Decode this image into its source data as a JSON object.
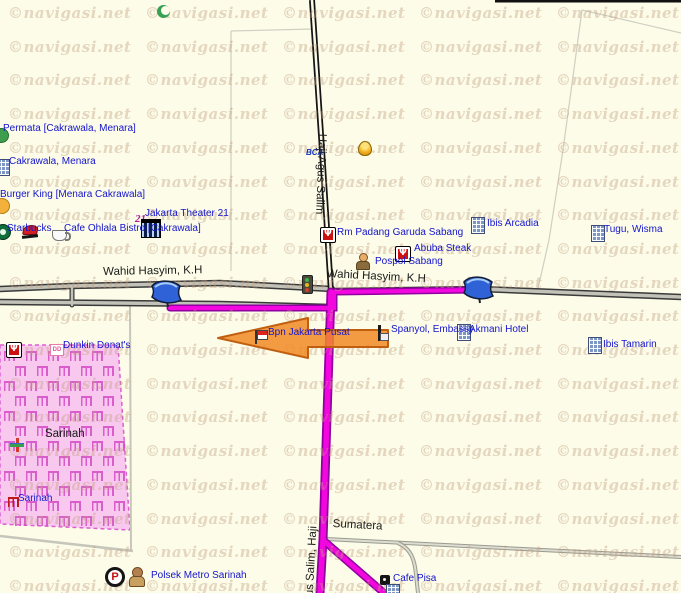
{
  "watermark": {
    "text": "©navigasi.net"
  },
  "map": {
    "colors": {
      "background": "#FCFCE8",
      "route": "#F207DE",
      "arrow": "#F18A26",
      "area_pink": "#F8C8EF",
      "poi_label": "#1414CC",
      "road_label": "#1B1B1B",
      "watermark": "rgba(196,158,128,0.40)"
    },
    "road_labels": [
      {
        "text": "Wahid Hasyim, K.H",
        "x": 103,
        "y": 266,
        "rot": -1
      },
      {
        "text": "Wahid Hasyim, K.H",
        "x": 327,
        "y": 268,
        "rot": 3
      },
      {
        "text": "Haji Agus Salim",
        "x": 328,
        "y": 134,
        "rot": 92
      },
      {
        "text": "Agus Salim, Haji",
        "x": 303,
        "y": 610,
        "rot": -87
      },
      {
        "text": "Sumatera",
        "x": 333,
        "y": 518,
        "rot": 3
      },
      {
        "text": "Sarinah",
        "x": 45,
        "y": 428,
        "rot": 0
      }
    ],
    "poi_labels": [
      {
        "text": "Permata [Cakrawala, Menara]",
        "x": 3,
        "y": 123
      },
      {
        "text": "Cakrawala, Menara",
        "x": 9,
        "y": 156
      },
      {
        "text": "Burger King [Menara Cakrawala]",
        "x": 0,
        "y": 189
      },
      {
        "text": "Jakarta Theater 21",
        "x": 145,
        "y": 208
      },
      {
        "text": "Starbucks",
        "x": 7,
        "y": 223
      },
      {
        "text": "Cafe Ohlala Bistro [Cakrawala]",
        "x": 64,
        "y": 223
      },
      {
        "text": "Rm Padang Garuda Sabang",
        "x": 337,
        "y": 227
      },
      {
        "text": "Abuba Steak",
        "x": 414,
        "y": 243
      },
      {
        "text": "Pospol Sabang",
        "x": 375,
        "y": 256
      },
      {
        "text": "Ibis Arcadia",
        "x": 487,
        "y": 218
      },
      {
        "text": "Tugu, Wisma",
        "x": 604,
        "y": 224
      },
      {
        "text": "Akmani Hotel",
        "x": 469,
        "y": 324
      },
      {
        "text": "Ibis Tamarin",
        "x": 603,
        "y": 339
      },
      {
        "text": "Spanyol, Embassy",
        "x": 391,
        "y": 324
      },
      {
        "text": "Bpn Jakarta Pusat",
        "x": 268,
        "y": 327
      },
      {
        "text": "Dunkin Donat's",
        "x": 63,
        "y": 340
      },
      {
        "text": "Sarinah",
        "x": 18,
        "y": 493
      },
      {
        "text": "Polsek Metro Sarinah",
        "x": 151,
        "y": 570
      },
      {
        "text": "Cafe Pisa",
        "x": 393,
        "y": 573
      }
    ],
    "icons": [
      {
        "name": "mosque-icon",
        "x": 157,
        "y": 5
      },
      {
        "name": "bca-icon",
        "x": 306,
        "y": 142
      },
      {
        "name": "bell-icon",
        "x": 358,
        "y": 141
      },
      {
        "name": "tree-icon",
        "x": -6,
        "y": 128
      },
      {
        "name": "building-icon",
        "x": -4,
        "y": 159
      },
      {
        "name": "bk-icon",
        "x": -6,
        "y": 198
      },
      {
        "name": "two1-icon",
        "x": 135,
        "y": 209
      },
      {
        "name": "theater-icon",
        "x": 141,
        "y": 219
      },
      {
        "name": "starbucks-icon",
        "x": -5,
        "y": 224
      },
      {
        "name": "pizzahut-icon",
        "x": 22,
        "y": 225
      },
      {
        "name": "coffee-icon",
        "x": 52,
        "y": 230
      },
      {
        "name": "restaurant-icon",
        "x": 320,
        "y": 227
      },
      {
        "name": "restaurant-icon",
        "x": 395,
        "y": 246
      },
      {
        "name": "police-icon",
        "x": 356,
        "y": 253
      },
      {
        "name": "building-icon",
        "x": 471,
        "y": 217
      },
      {
        "name": "building-icon",
        "x": 591,
        "y": 225
      },
      {
        "name": "traffic-light-icon",
        "x": 302,
        "y": 275
      },
      {
        "name": "building-icon",
        "x": 457,
        "y": 324
      },
      {
        "name": "building-icon",
        "x": 588,
        "y": 337
      },
      {
        "name": "flag-id-icon",
        "x": 255,
        "y": 330
      },
      {
        "name": "embassy-icon",
        "x": 378,
        "y": 325
      },
      {
        "name": "restaurant-icon",
        "x": 6,
        "y": 342
      },
      {
        "name": "dunkin-icon",
        "x": 50,
        "y": 344
      },
      {
        "name": "gift-icon",
        "x": 10,
        "y": 438
      },
      {
        "name": "shop-icon",
        "x": 8,
        "y": 497
      },
      {
        "name": "parking-icon",
        "x": 105,
        "y": 567
      },
      {
        "name": "bear-icon",
        "x": 128,
        "y": 567
      },
      {
        "name": "cafe-icon",
        "x": 380,
        "y": 575
      },
      {
        "name": "building-icon",
        "x": 386,
        "y": 584
      }
    ]
  }
}
